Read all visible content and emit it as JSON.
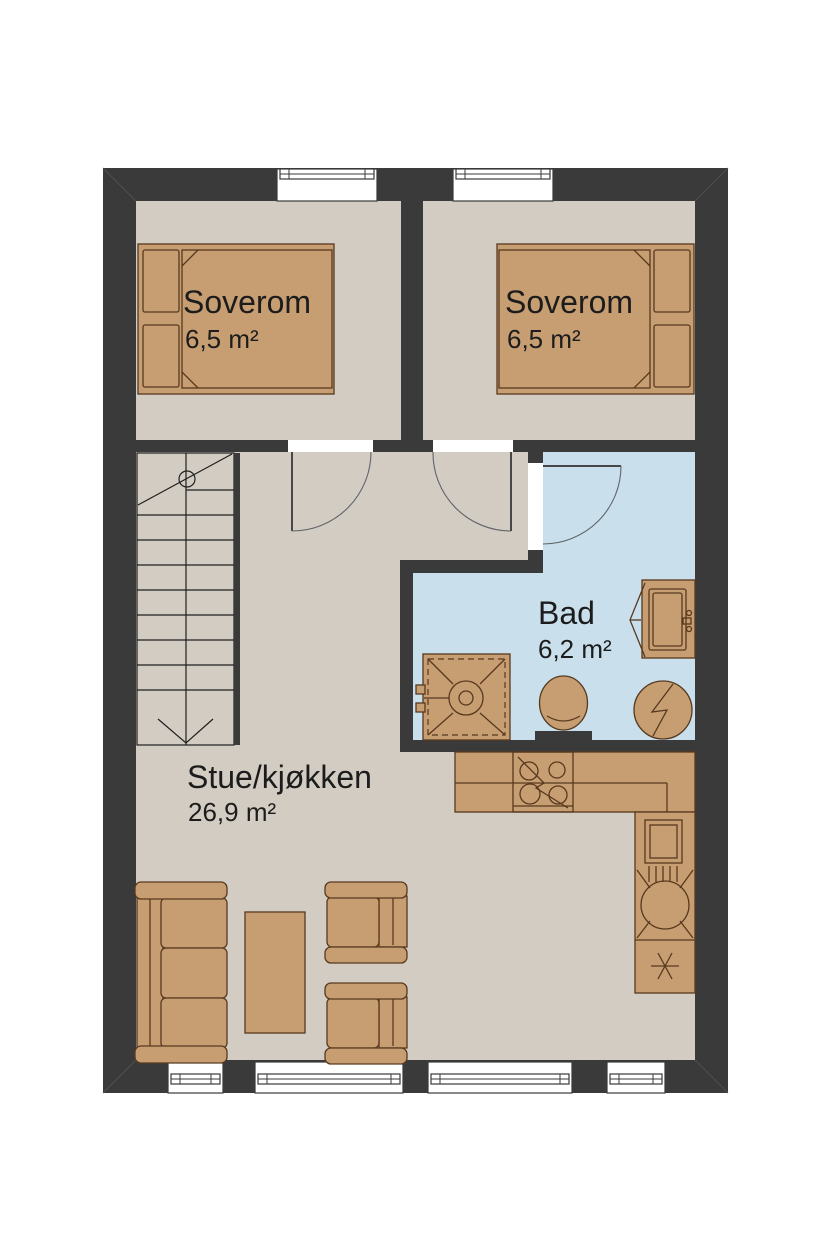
{
  "plan": {
    "type": "floor-plan",
    "rooms": [
      {
        "id": "bedroom-1",
        "name": "Soverom",
        "area": "6,5 m²"
      },
      {
        "id": "bedroom-2",
        "name": "Soverom",
        "area": "6,5 m²"
      },
      {
        "id": "bathroom",
        "name": "Bad",
        "area": "6,2 m²"
      },
      {
        "id": "living-kitchen",
        "name": "Stue/kjøkken",
        "area": "26,9 m²"
      }
    ],
    "fixtures": [
      "double-bed",
      "double-bed",
      "staircase",
      "shower",
      "toilet",
      "washing-machine",
      "sink-vanity",
      "kitchen-counter",
      "stove",
      "kitchen-sink",
      "freezer",
      "sofa",
      "coffee-table",
      "armchair",
      "armchair"
    ],
    "window_count": {
      "top_wall": 2,
      "bottom_wall": 4
    },
    "colors": {
      "wall": "#3a3a3a",
      "floor": "#d3ccc3",
      "bath_floor": "#c9dfec",
      "furniture": "#c79d72",
      "furniture_outline": "#57391e",
      "text": "#1c1c1c",
      "window": "#ffffff",
      "page_bg": "#ffffff"
    }
  }
}
